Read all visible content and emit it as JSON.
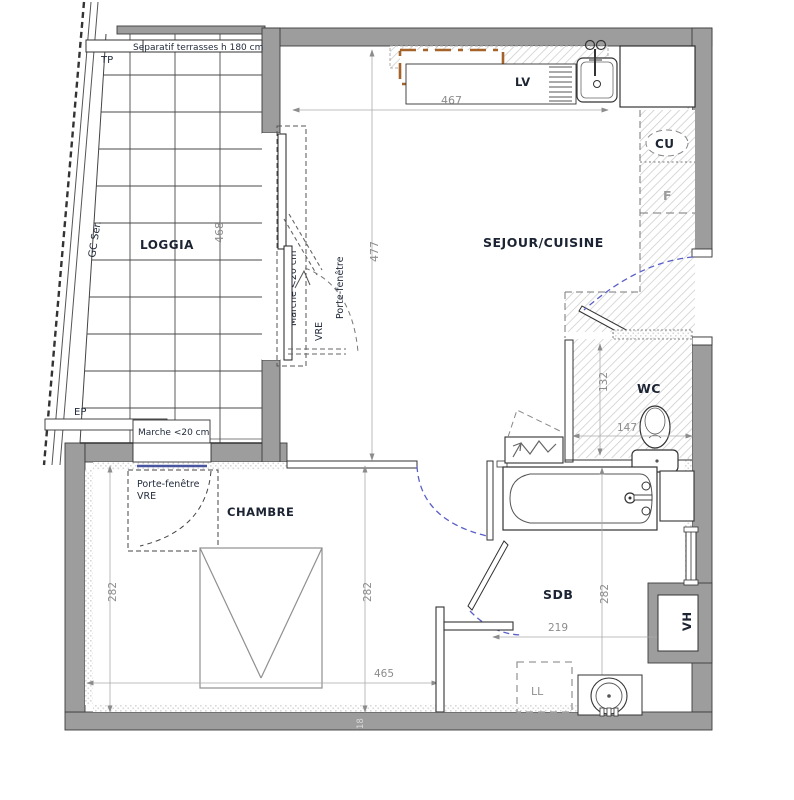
{
  "rooms": {
    "loggia": "LOGGIA",
    "sejour_cuisine": "SEJOUR/CUISINE",
    "wc": "WC",
    "chambre": "CHAMBRE",
    "sdb": "SDB"
  },
  "appliances": {
    "lave_vaisselle": "LV",
    "cuisson": "CU",
    "frigo": "F",
    "lave_linge": "LL",
    "ventilation_haute": "VH"
  },
  "annotations": {
    "separatif_terrasses": "Separatif terrasses h 180 cm",
    "tp": "TP",
    "gc_ser": "GC Ser.",
    "ep": "EP",
    "marche_loggia_step": "Marche <20 cm",
    "marche_loggia_side": "Marche <20 cm",
    "porte_fenetre_sejour": "Porte-fenêtre",
    "porte_fenetre_sejour_type": "VRE",
    "porte_fenetre_chambre": "Porte-fenêtre",
    "porte_fenetre_chambre_type": "VRE"
  },
  "dimensions_cm": {
    "sejour_width": "467",
    "sejour_depth": "477",
    "loggia_length": "468",
    "wc_depth": "132",
    "wc_width": "147",
    "chambre_depth_left": "282",
    "chambre_depth_mid": "282",
    "sdb_depth": "282",
    "chambre_width": "465",
    "sdb_width": "219",
    "wall_thickness": "18"
  },
  "colors": {
    "wall": "#9d9d9d",
    "line": "#3c3c3c",
    "door_swing_blue": "#5a5fc7",
    "window_accent_orange": "#a5632a",
    "glazing_blue": "#4a55a0",
    "dim_gray": "#8c8c8c"
  }
}
